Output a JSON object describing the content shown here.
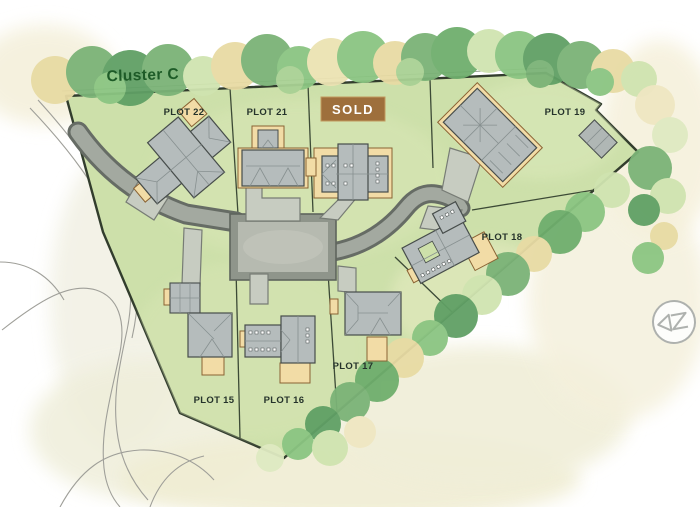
{
  "title": {
    "label": "Cluster C"
  },
  "plots": [
    {
      "id": "15",
      "label": "PLOT 15"
    },
    {
      "id": "16",
      "label": "PLOT 16"
    },
    {
      "id": "17",
      "label": "PLOT 17"
    },
    {
      "id": "18",
      "label": "PLOT 18"
    },
    {
      "id": "19",
      "label": "PLOT 19"
    },
    {
      "id": "21",
      "label": "PLOT 21"
    },
    {
      "id": "22",
      "label": "PLOT 22"
    }
  ],
  "sold_badge": {
    "label": "SOLD",
    "bg": "#9e6f3c",
    "text_color": "#ffffff"
  },
  "icons": {
    "compass": "north-arrow"
  },
  "colors": {
    "title": "#1d5b27",
    "plot_label": "#25332b",
    "sold_bg": "#9e6f3c",
    "sold_text": "#ffffff",
    "site_green": "#cde0aa",
    "boundary": "#323d2d",
    "road_gray": "#a3a9a0",
    "road_edge": "#666c65",
    "driveway": "#c7ccc1",
    "roof_gray": "#b5bcbc",
    "patio_tan": "#f2dca6",
    "tree_dark": "#60a065",
    "tree_mid": "#7bb377",
    "tree_light": "#8bc582",
    "tree_tan": "#e8dba4"
  }
}
